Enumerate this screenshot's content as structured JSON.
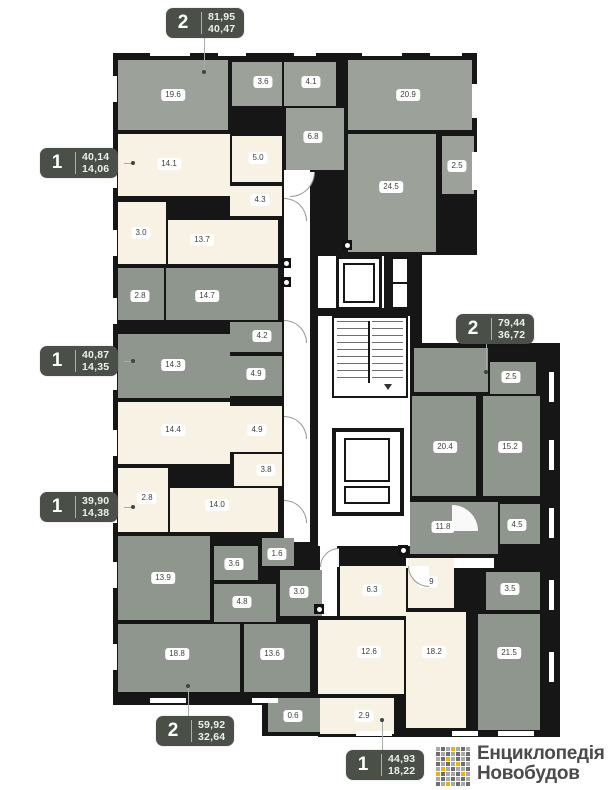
{
  "page": {
    "width": 609,
    "height": 790,
    "background": "#ffffff"
  },
  "palette": {
    "wall": "#161616",
    "gray_a": "#9ca29a",
    "gray_b": "#8f968d",
    "cream": "#f7f2e4",
    "floor_white": "#ffffff",
    "badge_bg": "#4a4f48",
    "badge_text": "#eef0ea",
    "pill_text": "#3c423c",
    "leader": "#a9ada9",
    "logo_text": "#4b4b4b"
  },
  "structure": {
    "black_blocks": [
      {
        "x": 113,
        "y": 53,
        "w": 364,
        "h": 202
      },
      {
        "x": 113,
        "y": 250,
        "w": 230,
        "h": 455
      },
      {
        "x": 308,
        "y": 250,
        "w": 114,
        "h": 300
      },
      {
        "x": 408,
        "y": 343,
        "w": 152,
        "h": 394
      },
      {
        "x": 318,
        "y": 540,
        "w": 110,
        "h": 197
      },
      {
        "x": 262,
        "y": 694,
        "w": 66,
        "h": 42
      }
    ],
    "white_areas": [
      {
        "name": "corridor",
        "x": 284,
        "y": 170,
        "w": 26,
        "h": 372
      },
      {
        "name": "elevator-lobby",
        "x": 318,
        "y": 256,
        "w": 92,
        "h": 290
      },
      {
        "name": "corridor",
        "x": 320,
        "y": 544,
        "w": 17,
        "h": 72
      },
      {
        "name": "corridor",
        "x": 406,
        "y": 558,
        "w": 88,
        "h": 10
      }
    ],
    "windows": [
      {
        "x": 112,
        "y": 76,
        "w": 5,
        "h": 26
      },
      {
        "x": 112,
        "y": 162,
        "w": 5,
        "h": 26
      },
      {
        "x": 112,
        "y": 230,
        "w": 5,
        "h": 26
      },
      {
        "x": 112,
        "y": 298,
        "w": 5,
        "h": 26
      },
      {
        "x": 112,
        "y": 364,
        "w": 5,
        "h": 26
      },
      {
        "x": 112,
        "y": 430,
        "w": 5,
        "h": 26
      },
      {
        "x": 112,
        "y": 497,
        "w": 5,
        "h": 26
      },
      {
        "x": 112,
        "y": 562,
        "w": 5,
        "h": 26
      },
      {
        "x": 112,
        "y": 644,
        "w": 5,
        "h": 26
      },
      {
        "x": 150,
        "y": 51,
        "w": 40,
        "h": 5
      },
      {
        "x": 218,
        "y": 51,
        "w": 28,
        "h": 5
      },
      {
        "x": 294,
        "y": 51,
        "w": 22,
        "h": 5
      },
      {
        "x": 362,
        "y": 51,
        "w": 40,
        "h": 5
      },
      {
        "x": 430,
        "y": 51,
        "w": 32,
        "h": 5
      },
      {
        "x": 472,
        "y": 84,
        "w": 5,
        "h": 34
      },
      {
        "x": 472,
        "y": 152,
        "w": 5,
        "h": 38
      },
      {
        "x": 549,
        "y": 372,
        "w": 5,
        "h": 30
      },
      {
        "x": 549,
        "y": 440,
        "w": 5,
        "h": 30
      },
      {
        "x": 549,
        "y": 508,
        "w": 5,
        "h": 30
      },
      {
        "x": 549,
        "y": 580,
        "w": 5,
        "h": 30
      },
      {
        "x": 549,
        "y": 652,
        "w": 5,
        "h": 30
      },
      {
        "x": 356,
        "y": 731,
        "w": 36,
        "h": 5
      },
      {
        "x": 452,
        "y": 731,
        "w": 26,
        "h": 5
      },
      {
        "x": 498,
        "y": 731,
        "w": 36,
        "h": 5
      },
      {
        "x": 150,
        "y": 698,
        "w": 36,
        "h": 5
      },
      {
        "x": 252,
        "y": 698,
        "w": 26,
        "h": 5
      }
    ],
    "vents": [
      {
        "x": 281,
        "y": 258
      },
      {
        "x": 281,
        "y": 277
      },
      {
        "x": 342,
        "y": 240
      },
      {
        "x": 314,
        "y": 604
      },
      {
        "x": 398,
        "y": 545
      }
    ],
    "doors": [
      {
        "x": 284,
        "y": 198,
        "s": 22,
        "rot": 90
      },
      {
        "x": 284,
        "y": 320,
        "s": 22,
        "rot": 90
      },
      {
        "x": 284,
        "y": 416,
        "s": 22,
        "rot": 90
      },
      {
        "x": 284,
        "y": 500,
        "s": 22,
        "rot": 90
      },
      {
        "x": 320,
        "y": 548,
        "s": 18,
        "rot": 0
      },
      {
        "x": 290,
        "y": 172,
        "s": 24,
        "rot": 180
      },
      {
        "x": 452,
        "y": 504,
        "s": 26,
        "rot": 90
      },
      {
        "x": 408,
        "y": 566,
        "s": 20,
        "rot": 270
      }
    ]
  },
  "core": {
    "divider1": {
      "x": 318,
      "y": 308,
      "w": 92,
      "h": 8
    },
    "divider2": {
      "x": 384,
      "y": 256,
      "w": 6,
      "h": 54
    },
    "elevator": {
      "x": 336,
      "y": 256,
      "w": 46,
      "h": 54
    },
    "shaft": {
      "x": 390,
      "y": 256,
      "w": 20,
      "h": 54
    },
    "stairs": {
      "x": 332,
      "y": 316,
      "w": 76,
      "h": 82
    },
    "lower_shaft": {
      "x": 332,
      "y": 428,
      "w": 72,
      "h": 88
    }
  },
  "apartments": [
    {
      "fill": "gray_a",
      "badge": {
        "num": "2",
        "total": "81,95",
        "living": "40,47",
        "x": 166,
        "y": 8,
        "leader": {
          "x1": 204,
          "y1": 38,
          "x2": 204,
          "y2": 72
        }
      },
      "rooms": [
        {
          "label": "19.6",
          "x": 118,
          "y": 60,
          "w": 110,
          "h": 70,
          "lx": 173,
          "ly": 95
        },
        {
          "label": "3.6",
          "x": 232,
          "y": 62,
          "w": 50,
          "h": 44,
          "lx": 263,
          "ly": 82
        },
        {
          "label": "4.1",
          "x": 284,
          "y": 62,
          "w": 52,
          "h": 44,
          "lx": 311,
          "ly": 82
        },
        {
          "label": "6.8",
          "x": 286,
          "y": 108,
          "w": 58,
          "h": 62,
          "lx": 313,
          "ly": 137
        },
        {
          "label": "20.9",
          "x": 348,
          "y": 60,
          "w": 124,
          "h": 70,
          "lx": 408,
          "ly": 95
        },
        {
          "label": "24.5",
          "x": 348,
          "y": 134,
          "w": 88,
          "h": 118,
          "lx": 391,
          "ly": 187
        },
        {
          "label": "2.5",
          "x": 442,
          "y": 136,
          "w": 32,
          "h": 58,
          "lx": 457,
          "ly": 166
        }
      ]
    },
    {
      "fill": "cream",
      "badge": {
        "num": "1",
        "total": "40,14",
        "living": "14,06",
        "x": 40,
        "y": 148,
        "leader": {
          "x1": 124,
          "y1": 163,
          "x2": 133,
          "y2": 163
        }
      },
      "rooms": [
        {
          "label": "14.1",
          "x": 118,
          "y": 134,
          "w": 112,
          "h": 62,
          "lx": 169,
          "ly": 164
        },
        {
          "label": "5.0",
          "x": 232,
          "y": 136,
          "w": 50,
          "h": 46,
          "lx": 258,
          "ly": 158
        },
        {
          "label": "4.3",
          "x": 230,
          "y": 186,
          "w": 52,
          "h": 30,
          "lx": 260,
          "ly": 200
        },
        {
          "label": "3.0",
          "x": 118,
          "y": 202,
          "w": 48,
          "h": 62,
          "lx": 141,
          "ly": 233
        },
        {
          "label": "13.7",
          "x": 168,
          "y": 220,
          "w": 110,
          "h": 44,
          "lx": 202,
          "ly": 240
        }
      ]
    },
    {
      "fill": "gray_b",
      "badge": {
        "num": "1",
        "total": "40,87",
        "living": "14,35",
        "x": 40,
        "y": 346,
        "leader": {
          "x1": 124,
          "y1": 361,
          "x2": 133,
          "y2": 361
        }
      },
      "rooms": [
        {
          "label": "2.8",
          "x": 118,
          "y": 268,
          "w": 46,
          "h": 52,
          "lx": 140,
          "ly": 296
        },
        {
          "label": "14.7",
          "x": 166,
          "y": 268,
          "w": 112,
          "h": 52,
          "lx": 207,
          "ly": 296
        },
        {
          "label": "4.2",
          "x": 230,
          "y": 322,
          "w": 52,
          "h": 30,
          "lx": 262,
          "ly": 336
        },
        {
          "label": "14.3",
          "x": 118,
          "y": 334,
          "w": 112,
          "h": 64,
          "lx": 173,
          "ly": 365
        },
        {
          "label": "4.9",
          "x": 230,
          "y": 356,
          "w": 52,
          "h": 40,
          "lx": 256,
          "ly": 374
        }
      ]
    },
    {
      "fill": "cream",
      "badge": {
        "num": "1",
        "total": "39,90",
        "living": "14,38",
        "x": 40,
        "y": 492,
        "leader": {
          "x1": 124,
          "y1": 507,
          "x2": 133,
          "y2": 507
        }
      },
      "rooms": [
        {
          "label": "14.4",
          "x": 118,
          "y": 402,
          "w": 112,
          "h": 62,
          "lx": 173,
          "ly": 430
        },
        {
          "label": "4.9",
          "x": 230,
          "y": 406,
          "w": 52,
          "h": 46,
          "lx": 257,
          "ly": 430
        },
        {
          "label": "3.8",
          "x": 234,
          "y": 454,
          "w": 48,
          "h": 32,
          "lx": 266,
          "ly": 470
        },
        {
          "label": "2.8",
          "x": 118,
          "y": 468,
          "w": 50,
          "h": 64,
          "lx": 147,
          "ly": 498
        },
        {
          "label": "14.0",
          "x": 170,
          "y": 488,
          "w": 108,
          "h": 44,
          "lx": 217,
          "ly": 505
        }
      ]
    },
    {
      "fill": "gray_b",
      "badge": {
        "num": "2",
        "total": "59,92",
        "living": "32,64",
        "x": 156,
        "y": 716,
        "leader": {
          "x1": 188,
          "y1": 686,
          "x2": 188,
          "y2": 686,
          "y1b": 716
        }
      },
      "rooms": [
        {
          "label": "13.9",
          "x": 118,
          "y": 536,
          "w": 92,
          "h": 84,
          "lx": 163,
          "ly": 578
        },
        {
          "label": "3.6",
          "x": 214,
          "y": 546,
          "w": 44,
          "h": 34,
          "lx": 234,
          "ly": 564
        },
        {
          "label": "1.6",
          "x": 262,
          "y": 538,
          "w": 32,
          "h": 28,
          "lx": 277,
          "ly": 554
        },
        {
          "label": "4.8",
          "x": 214,
          "y": 584,
          "w": 62,
          "h": 38,
          "lx": 242,
          "ly": 602
        },
        {
          "label": "3.0",
          "x": 280,
          "y": 570,
          "w": 42,
          "h": 46,
          "lx": 299,
          "ly": 592
        },
        {
          "label": "18.8",
          "x": 118,
          "y": 624,
          "w": 122,
          "h": 68,
          "lx": 177,
          "ly": 654
        },
        {
          "label": "13.6",
          "x": 244,
          "y": 624,
          "w": 66,
          "h": 68,
          "lx": 272,
          "ly": 654
        },
        {
          "label": "0.6",
          "x": 268,
          "y": 698,
          "w": 56,
          "h": 34,
          "lx": 293,
          "ly": 716
        }
      ]
    },
    {
      "fill": "cream",
      "badge": {
        "num": "1",
        "total": "44,93",
        "living": "18,22",
        "x": 346,
        "y": 750,
        "leader": {
          "x1": 382,
          "y1": 720,
          "x2": 382,
          "y2": 720,
          "y1b": 750
        }
      },
      "rooms": [
        {
          "label": "6.3",
          "x": 340,
          "y": 566,
          "w": 66,
          "h": 50,
          "lx": 372,
          "ly": 590
        },
        {
          "label": "4.9",
          "x": 408,
          "y": 558,
          "w": 46,
          "h": 50,
          "lx": 428,
          "ly": 582
        },
        {
          "label": "12.6",
          "x": 318,
          "y": 620,
          "w": 86,
          "h": 74,
          "lx": 369,
          "ly": 652
        },
        {
          "label": "18.2",
          "x": 406,
          "y": 612,
          "w": 60,
          "h": 116,
          "lx": 434,
          "ly": 652
        },
        {
          "label": "2.9",
          "x": 320,
          "y": 698,
          "w": 74,
          "h": 36,
          "lx": 364,
          "ly": 716
        }
      ]
    },
    {
      "fill": "gray_b",
      "badge": {
        "num": "2",
        "total": "79,44",
        "living": "36,72",
        "x": 456,
        "y": 314,
        "leader": {
          "x1": 486,
          "y1": 344,
          "x2": 486,
          "y2": 372
        }
      },
      "rooms": [
        {
          "label": "",
          "x": 414,
          "y": 348,
          "w": 74,
          "h": 44,
          "lx": 0,
          "ly": 0
        },
        {
          "label": "2.5",
          "x": 490,
          "y": 362,
          "w": 46,
          "h": 32,
          "lx": 511,
          "ly": 377
        },
        {
          "label": "20.4",
          "x": 412,
          "y": 396,
          "w": 64,
          "h": 100,
          "lx": 445,
          "ly": 447
        },
        {
          "label": "15.2",
          "x": 483,
          "y": 396,
          "w": 57,
          "h": 100,
          "lx": 510,
          "ly": 447
        },
        {
          "label": "11.8",
          "x": 410,
          "y": 502,
          "w": 88,
          "h": 52,
          "lx": 443,
          "ly": 527
        },
        {
          "label": "4.5",
          "x": 500,
          "y": 504,
          "w": 40,
          "h": 40,
          "lx": 517,
          "ly": 525
        },
        {
          "label": "3.5",
          "x": 486,
          "y": 572,
          "w": 54,
          "h": 38,
          "lx": 510,
          "ly": 589
        },
        {
          "label": "21.5",
          "x": 478,
          "y": 614,
          "w": 62,
          "h": 116,
          "lx": 509,
          "ly": 653
        }
      ]
    }
  ],
  "logo": {
    "line1": "Енциклопедія",
    "line2": "Новобудов",
    "colors": {
      "d": "#6e6e6e",
      "l": "#a9a9a9",
      "y": "#f0b400"
    },
    "grid": [
      [
        "l",
        "d",
        "l",
        "y",
        "l",
        "d",
        "l"
      ],
      [
        "d",
        "l",
        "d",
        "l",
        "d",
        "l",
        "d"
      ],
      [
        "l",
        "d",
        "y",
        "l",
        "d",
        "l",
        "d"
      ],
      [
        "d",
        "l",
        "d",
        "l",
        "y",
        "d",
        "l"
      ],
      [
        "l",
        "y",
        "l",
        "d",
        "l",
        "l",
        "d"
      ],
      [
        "y",
        "d",
        "l",
        "l",
        "d",
        "y",
        "l"
      ],
      [
        "l",
        "d",
        "l",
        "d",
        "l",
        "d",
        "l"
      ],
      [
        "d",
        "l",
        "y",
        "l",
        "d",
        "l",
        "d"
      ]
    ]
  }
}
